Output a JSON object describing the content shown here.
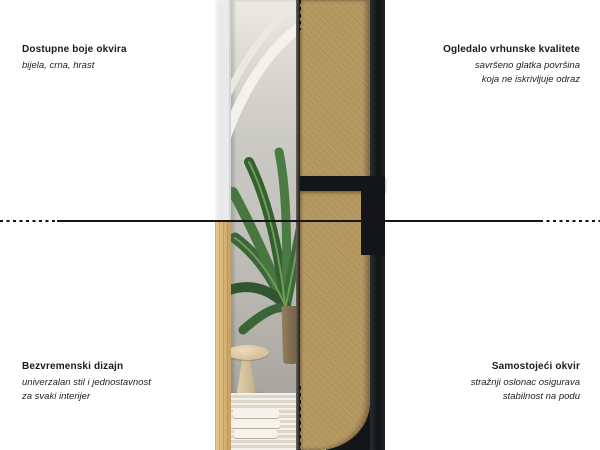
{
  "page": {
    "width": 600,
    "height": 450,
    "background": "#ffffff",
    "description": "Product infographic of a free-standing full-length mirror, front and back view split by dotted guides, with four Croatian feature callouts"
  },
  "callouts": {
    "top_left": {
      "title": "Dostupne boje okvira",
      "lines": [
        "bijela, crna, hrast"
      ]
    },
    "top_right": {
      "title": "Ogledalo vrhunske kvalitete",
      "lines": [
        "savršeno glatka površina",
        "koja ne iskrivljuje odraz"
      ]
    },
    "bottom_left": {
      "title": "Bezvremenski dizajn",
      "lines": [
        "univerzalan stil i jednostavnost",
        "za svaki interijer"
      ]
    },
    "bottom_right": {
      "title": "Samostojeći okvir",
      "lines": [
        "stražnji oslonac osigurava",
        "stabilnost na podu"
      ]
    }
  },
  "colors": {
    "text": "#1a1a1a",
    "divider_line": "#141414",
    "white_frame": "#eaeaec",
    "oak_frame": "#d8b477",
    "black_frame": "#17181a",
    "mdf_board": "#b5975f",
    "palm_green": "#3c6639",
    "wall_gray": "#c3c2bc",
    "rug_beige": "#e6e1d5"
  }
}
